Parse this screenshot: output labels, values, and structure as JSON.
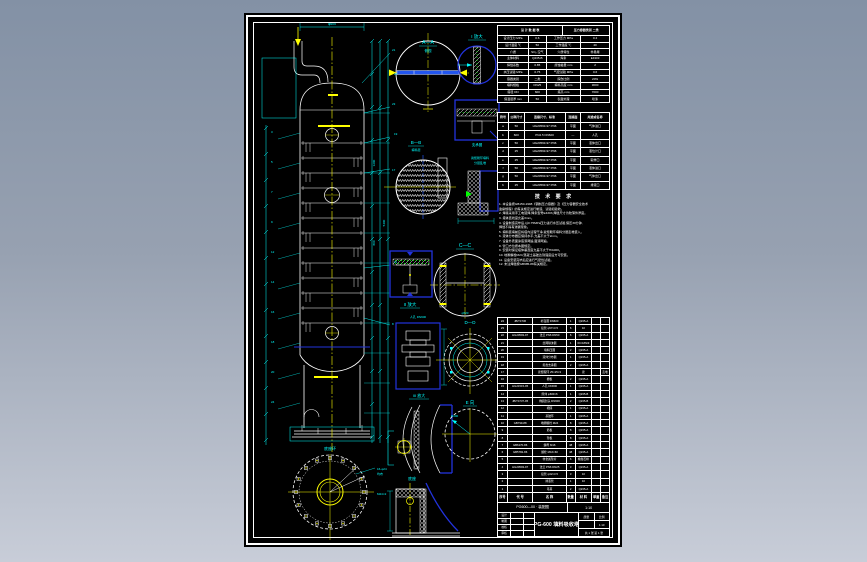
{
  "palette": {
    "background_top": "#8391a5",
    "background_bottom": "#c8cdd8",
    "paper": "#000000",
    "line": "#ffffff",
    "dim": "#00ffff",
    "centerline": "#ffff00",
    "detail": "#2233dd",
    "hatch_green": "#00ff00"
  },
  "drawing_labels": {
    "view_aa": "A—A",
    "view_aa_sub": "俯视",
    "detail_i": "I 放大",
    "ring_label": "支承圈",
    "view_bb": "B—B",
    "view_bb_sub": "填料层",
    "packing_note_1": "瓷矩鞍环填料",
    "packing_note_2": "分层乱堆",
    "detail_ii": "II 放大",
    "view_cc": "C—C",
    "manhole_label": "人孔 DN600",
    "view_dd": "D—D",
    "view_e": "E 向",
    "detail_iii": "III 放大",
    "base_detail": "底座",
    "base_ring": "底座环",
    "bolt_note": "16-φ24",
    "bolt_note2": "均布",
    "anchor_note": "M24×2",
    "dim_top": "φ600",
    "dim_cc": "φ520",
    "radius": "R300",
    "dim1": "1200",
    "dim2": "800",
    "dim3": "5400"
  },
  "callouts_left": [
    "3",
    "5",
    "7",
    "9",
    "12",
    "14",
    "16",
    "18",
    "20",
    "24"
  ],
  "callouts_right": [
    "21",
    "22",
    "23",
    "19",
    "17",
    "11",
    "8"
  ],
  "spec_table": {
    "head": [
      [
        "设 计 数 据 表",
        "压力容器类别 二类"
      ]
    ],
    "rows": [
      [
        "设计压力 MPa",
        "0.6",
        "工作压力 MPa",
        "0.4"
      ],
      [
        "设计温度 ℃",
        "50",
        "工作温度 ℃",
        "40"
      ],
      [
        "介质",
        "SO₂·空气",
        "介质特性",
        "非易爆"
      ],
      [
        "主体材料",
        "Q235-B",
        "焊条",
        "E4303"
      ],
      [
        "焊缝系数",
        "0.85",
        "腐蚀裕量 mm",
        "2"
      ],
      [
        "水压试验 MPa",
        "0.75",
        "气密试验 MPa",
        "0.6"
      ],
      [
        "容器类别",
        "二类",
        "探伤比例",
        "20%"
      ],
      [
        "填料规格",
        "DN25",
        "填料高度 mm",
        "3000"
      ],
      [
        "塔径 DN",
        "600",
        "塔高 mm",
        "7000"
      ],
      [
        "保温层厚 mm",
        "50",
        "表面处理",
        "喷漆"
      ]
    ]
  },
  "nozzle_table": {
    "head": [
      [
        "符号",
        "公称尺寸",
        "连接尺寸、标准",
        "连接面",
        "用途或名称"
      ]
    ],
    "rows": [
      [
        "a",
        "50",
        "HG20593-97 PN6",
        "平面",
        "气体进口"
      ],
      [
        "b",
        "600",
        "PN2.5 DN600",
        "—",
        "人孔"
      ],
      [
        "c",
        "50",
        "HG20593-97 PN6",
        "平面",
        "液体出口"
      ],
      [
        "d",
        "25",
        "HG20593-97 PN6",
        "平面",
        "液位计口"
      ],
      [
        "e",
        "25",
        "HG20593-97 PN6",
        "平面",
        "取样口"
      ],
      [
        "f",
        "50",
        "HG20593-97 PN6",
        "平面",
        "液体进口"
      ],
      [
        "g",
        "50",
        "HG20593-97 PN6",
        "平面",
        "气体出口"
      ],
      [
        "h",
        "25",
        "HG20593-97 PN6",
        "平面",
        "排液口"
      ]
    ]
  },
  "tech_notes": {
    "title": "技 术 要 求",
    "lines": [
      "1. 本设备按GB150-1998《钢制压力容器》及《压力容器安全技术",
      "   监察规程》的有关规定进行制造、试验和验收。",
      "2. 焊接采用手工电弧焊,焊条型号E4303,焊缝尺寸为较薄件厚度。",
      "3. 塔体直线度允差3mm。",
      "4. 设备制造完毕后,以0.75MPa压力进行水压试验,保压30分钟,",
      "   焊缝不得有渗漏现象。",
      "5. 填料装填前应将塔内清理干净,瓷矩鞍环填料分层乱堆装入。",
      "6. 液体分布器应保持水平,允差不大于2mm。",
      "7. 设备外表面涂底漆两遍,面漆两遍。",
      "8. 管口方位按本图规定。",
      "9. 安装时保证塔体垂直度允差不大于H/1000。",
      "10. 地脚螺栓M24,混凝土基础达到强度后方可安装。",
      "11. 设备安装完毕后应进行气密性试验。",
      "12. 未注焊缝按GB985-88有关规定。"
    ]
  },
  "bom": {
    "head": [
      [
        "序号",
        "代 号",
        "名 称",
        "数量",
        "材 料",
        "单重",
        "备注"
      ]
    ],
    "rows": [
      [
        "24",
        "JB/T4736",
        "补强圈 DN600",
        "1",
        "Q235-A",
        "",
        ""
      ],
      [
        "23",
        "",
        "接管 φ57×3.5",
        "6",
        "10",
        "",
        ""
      ],
      [
        "22",
        "HG20593-97",
        "法兰 PN6 DN50",
        "6",
        "Q235-A",
        "",
        ""
      ],
      [
        "21",
        "",
        "丝网除沫器",
        "1",
        "0Cr18Ni9",
        "",
        ""
      ],
      [
        "20",
        "",
        "填料压圈",
        "2",
        "Q235-A",
        "",
        ""
      ],
      [
        "19",
        "",
        "液体分布器",
        "1",
        "Q235-A",
        "",
        ""
      ],
      [
        "18",
        "",
        "塔盘支承圈",
        "2",
        "Q235-A",
        "",
        ""
      ],
      [
        "17",
        "",
        "瓷矩鞍环 25×25×3",
        "",
        "瓷",
        "",
        "乱堆"
      ],
      [
        "16",
        "",
        "栅板",
        "2",
        "Q235-A",
        "",
        ""
      ],
      [
        "15",
        "HG21515-95",
        "人孔 DN600",
        "1",
        "Q235-A",
        "",
        ""
      ],
      [
        "14",
        "",
        "筒体 φ600×6",
        "1",
        "Q235-B",
        "",
        ""
      ],
      [
        "13",
        "JB/T4737-95",
        "椭圆封头 DN600",
        "2",
        "Q235-B",
        "",
        ""
      ],
      [
        "12",
        "",
        "裙座",
        "1",
        "Q235-A",
        "",
        ""
      ],
      [
        "11",
        "",
        "基础环",
        "1",
        "Q235-A",
        "",
        ""
      ],
      [
        "10",
        "GB799-88",
        "地脚螺栓 M24",
        "8",
        "Q235-A",
        "",
        ""
      ],
      [
        "9",
        "",
        "筋板",
        "8",
        "Q235-A",
        "",
        ""
      ],
      [
        "8",
        "",
        "垫板",
        "8",
        "Q235-A",
        "",
        ""
      ],
      [
        "7",
        "GB6170-86",
        "螺母 M16",
        "48",
        "Q235-A",
        "",
        ""
      ],
      [
        "6",
        "GB5782-86",
        "螺栓 M16×60",
        "48",
        "Q235-A",
        "",
        ""
      ],
      [
        "5",
        "",
        "非金属垫片",
        "6",
        "橡胶石棉",
        "",
        ""
      ],
      [
        "4",
        "HG20593-97",
        "法兰 PN6 DN25",
        "3",
        "Q235-A",
        "",
        ""
      ],
      [
        "3",
        "",
        "接管 φ32×3.5",
        "3",
        "10",
        "",
        ""
      ],
      [
        "2",
        "",
        "排液管",
        "1",
        "10",
        "",
        ""
      ],
      [
        "1",
        "",
        "吊耳",
        "2",
        "Q235-A",
        "",
        ""
      ]
    ]
  },
  "title_block": {
    "doc_no": "PG600—00 · 装配图",
    "scale_top": "1:10",
    "sign_rows": [
      [
        "设计",
        "",
        ""
      ],
      [
        "制图",
        "",
        ""
      ],
      [
        "校核",
        "",
        ""
      ],
      [
        "审核",
        "",
        ""
      ]
    ],
    "main_title": "PG-600 填料吸收塔",
    "info": {
      "r1c1": "质量",
      "r1c2": "比例",
      "r2c1": "",
      "r2c2": "1:10",
      "r3": "共 1 张  第 1 张"
    }
  }
}
